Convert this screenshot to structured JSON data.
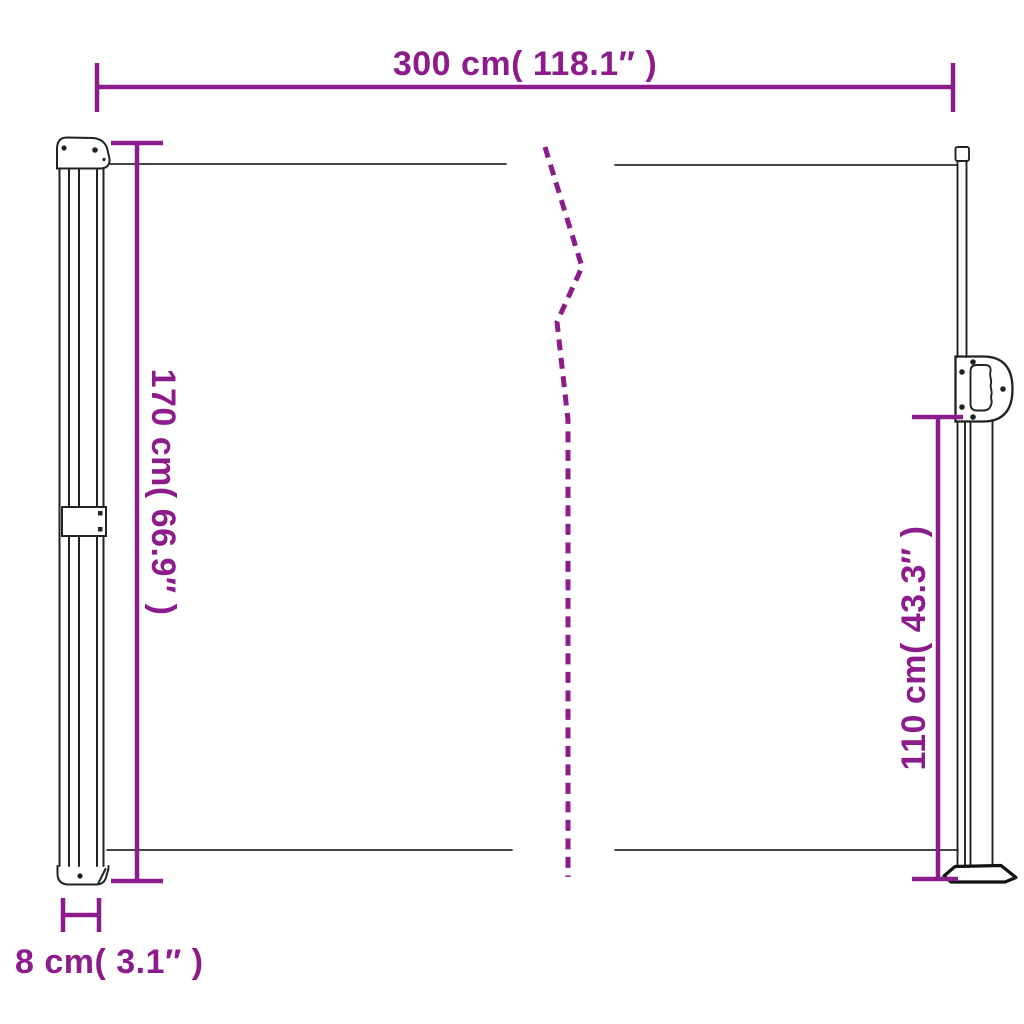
{
  "product": {
    "name": "Retractable side awning dimension diagram"
  },
  "colors": {
    "dimension": "#8C1B8C",
    "structure": "#222222",
    "fabric_line": "#2A2A2A",
    "base": "#111111",
    "background": "#FFFFFF"
  },
  "dimensions": {
    "width": {
      "label": "300 cm( 118.1″ )",
      "cm": "300",
      "inches": "118.1"
    },
    "left_height": {
      "label": "170 cm( 66.9″ )",
      "cm": "170",
      "inches": "66.9"
    },
    "right_height": {
      "label": "110 cm( 43.3″ )",
      "cm": "110",
      "inches": "43.3"
    },
    "cassette_depth": {
      "label": "8 cm( 3.1″ )",
      "cm": "8",
      "inches": "3.1"
    }
  }
}
